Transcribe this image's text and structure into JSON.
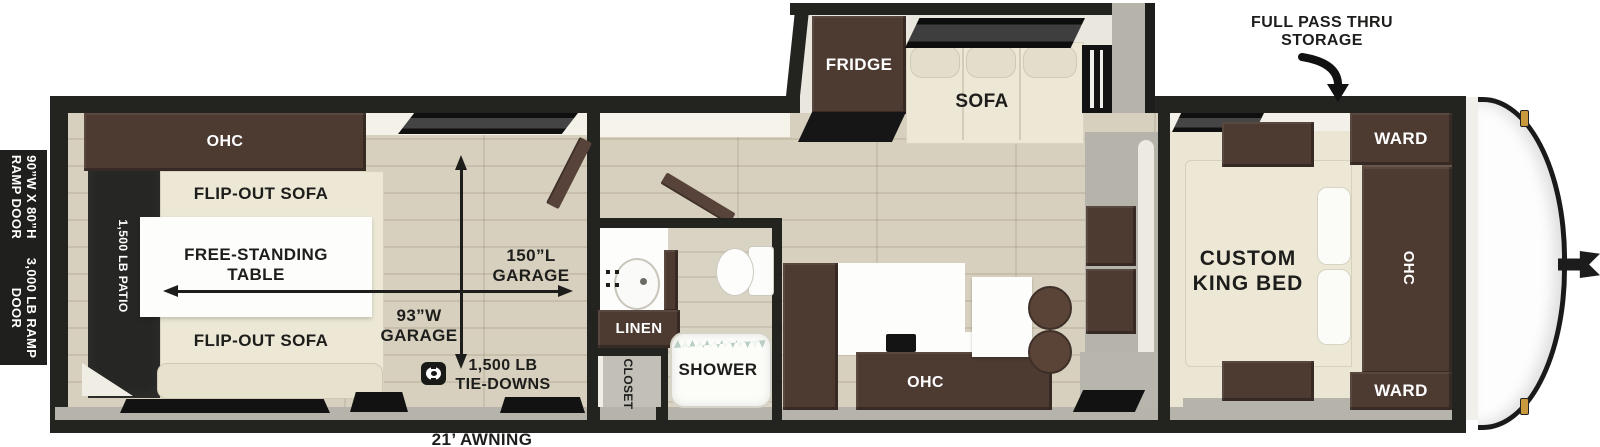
{
  "colors": {
    "wall_black": "#232320",
    "cabinet_brown": "#4d3b32",
    "upholstery_cream": "#ece8d5",
    "floor_wood": "#d7d0be",
    "bedroom_carpet": "#eae6d3",
    "patio_black": "#262624",
    "exterior_gray": "#b6b3ab",
    "marker_light_gold": "#c9993d"
  },
  "annotations": {
    "pass_thru_storage": "FULL PASS THRU\nSTORAGE",
    "awning": "21’ AWNING",
    "ramp_door_size": "90”W X 80”H\nRAMP DOOR",
    "ramp_door_capacity": "3,000 LB RAMP\nDOOR"
  },
  "garage": {
    "overhead_cabinet": "OHC",
    "sofa_top": "FLIP-OUT SOFA",
    "sofa_bottom": "FLIP-OUT SOFA",
    "table": "FREE-STANDING\nTABLE",
    "patio": "1,500 LB PATIO",
    "garage_length": "150”L\nGARAGE",
    "garage_width": "93”W\nGARAGE",
    "tie_downs": "1,500 LB\nTIE-DOWNS"
  },
  "bathroom": {
    "linen": "LINEN",
    "closet": "CLOSET",
    "shower": "SHOWER"
  },
  "kitchen": {
    "overhead_cabinet": "OHC"
  },
  "slide_out": {
    "fridge": "FRIDGE",
    "sofa": "SOFA"
  },
  "bedroom": {
    "bed": "CUSTOM\nKING BED",
    "wardrobe_top": "WARD",
    "wardrobe_bottom": "WARD",
    "overhead_cabinet": "OHC"
  }
}
